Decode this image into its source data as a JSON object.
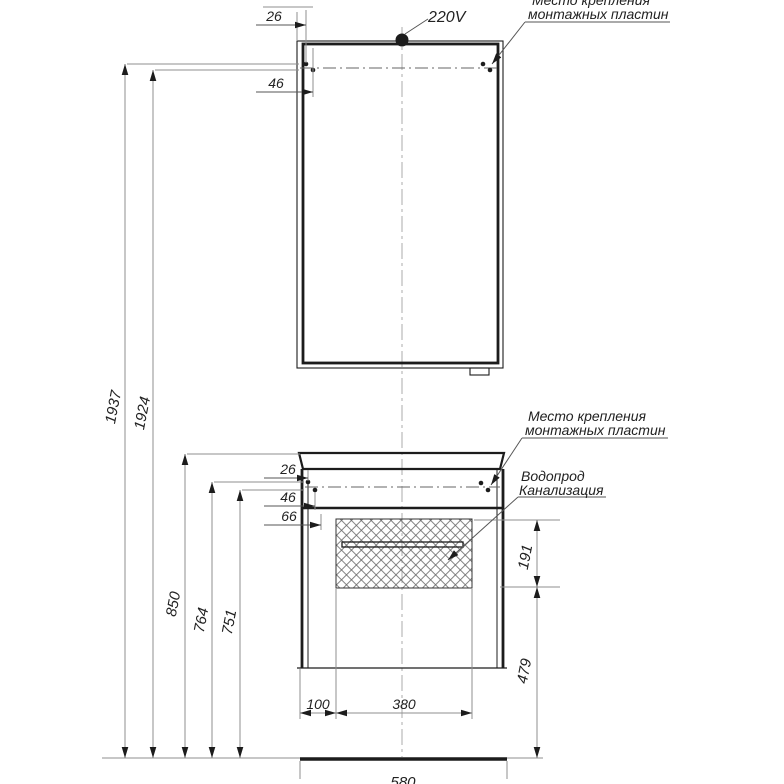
{
  "drawing": {
    "notes": {
      "power": "220V",
      "mirror_mount_line1": "Место крепления",
      "mirror_mount_line2": "монтажных пластин",
      "cabinet_mount_line1": "Место крепления",
      "cabinet_mount_line2": "монтажных пластин",
      "plumbing_line1": "Водопрод",
      "plumbing_line2": "Канализация"
    },
    "dimensions_mm": {
      "total_height_upper_mount": "1937",
      "total_height_lower_mount": "1924",
      "countertop_height": "850",
      "cabinet_upper_mount_height": "764",
      "cabinet_lower_mount_height": "751",
      "service_zone_height": "191",
      "cabinet_bottom_clearance": "479",
      "mirror_mount_offset_1": "26",
      "mirror_mount_offset_2": "46",
      "cabinet_mount_offset_1": "26",
      "cabinet_mount_offset_2": "46",
      "cabinet_mount_offset_3": "66",
      "service_zone_left_offset": "100",
      "service_zone_width": "380",
      "cabinet_width": "580"
    },
    "colors": {
      "outline": "#1c1c1c",
      "dimension": "#8f8f8f",
      "text": "#222222"
    }
  }
}
